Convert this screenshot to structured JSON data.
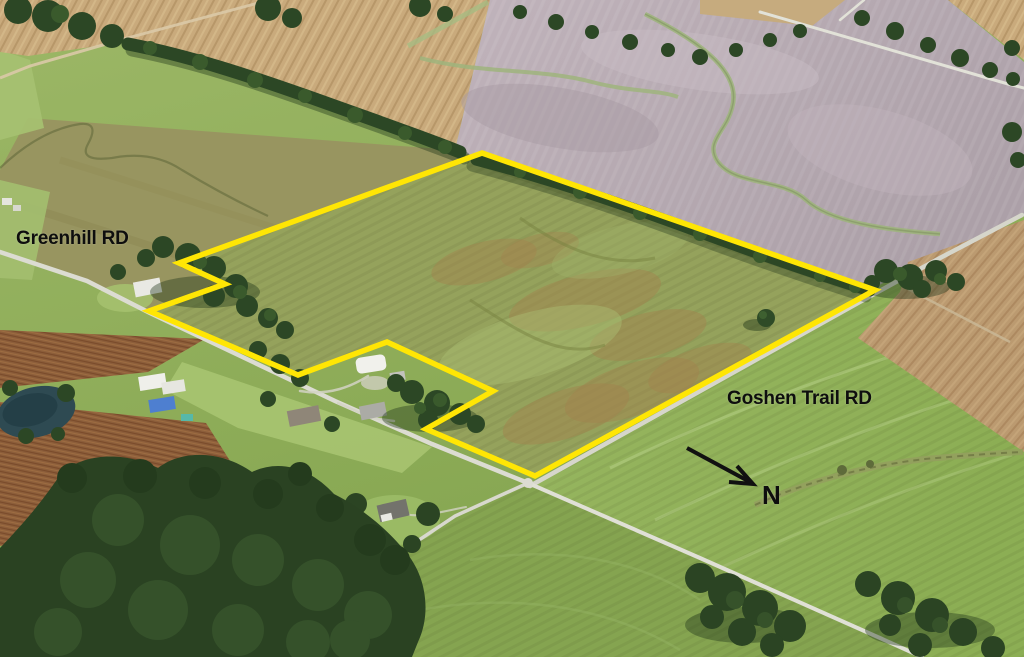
{
  "title": "Aerial parcel boundary map",
  "labels": {
    "road_left": "Greenhill RD",
    "road_right": "Goshen Trail RD",
    "compass": "N"
  },
  "annotations": {
    "parcel_boundary": {
      "color": "#ffe604",
      "stroke_width": 5.5,
      "points": [
        [
          482,
          153
        ],
        [
          875,
          290
        ],
        [
          535,
          476
        ],
        [
          426,
          429
        ],
        [
          493,
          391
        ],
        [
          387,
          342
        ],
        [
          298,
          375
        ],
        [
          149,
          311
        ],
        [
          225,
          284
        ],
        [
          179,
          263
        ]
      ]
    },
    "north_arrow": {
      "color": "#111111",
      "line": [
        [
          687,
          448
        ],
        [
          750,
          482
        ]
      ],
      "head": [
        [
          737,
          466
        ],
        [
          753,
          484
        ],
        [
          729,
          482
        ]
      ]
    }
  },
  "palette": {
    "boundary_yellow": "#ffe604",
    "label_text": "#0e0e0e",
    "field_green": "#8fae58",
    "field_bright_green": "#9cb765",
    "field_mauve": "#b5a8b0",
    "field_tan": "#c9aa7c",
    "field_olive": "#989560",
    "brush_brown": "#8d5f3b",
    "trees_dark": "#2c4725",
    "road_light": "#dcdcd2",
    "pond": "#2e4a52",
    "blue_roof": "#4e7fd0"
  }
}
